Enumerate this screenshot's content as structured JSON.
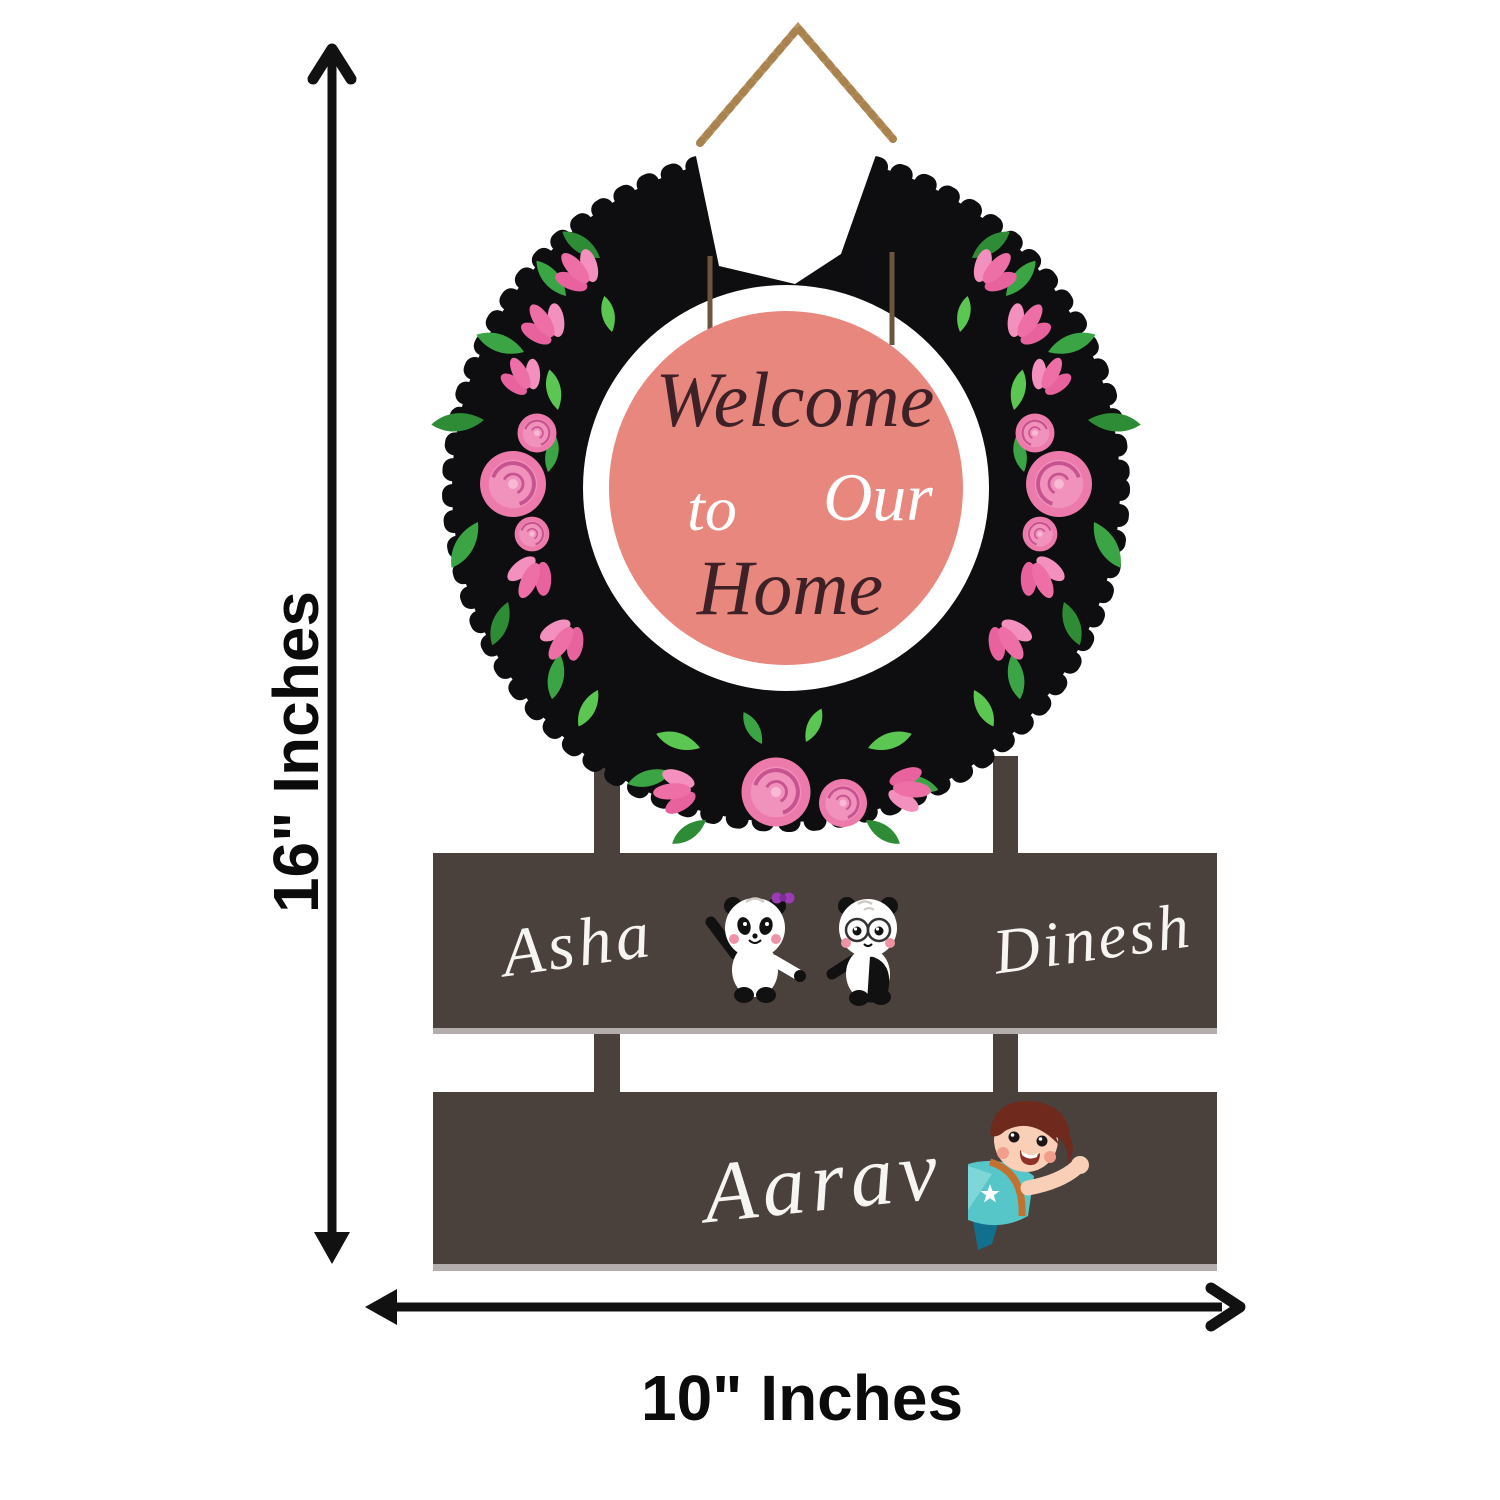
{
  "annotations": {
    "height_label": "16\" Inches",
    "width_label": "10\" Inches"
  },
  "sign": {
    "welcome_circle": {
      "word1": "Welcome",
      "word2": "to",
      "word3": "Our",
      "word4": "Home"
    },
    "plank_top": {
      "left_name": "Asha",
      "right_name": "Dinesh"
    },
    "plank_bottom": {
      "name": "Aarav"
    }
  },
  "icons": {
    "wreath": "floral-wreath",
    "rope": "jute-hanging-rope",
    "panda_left": "panda-with-bow-icon",
    "panda_right": "panda-with-glasses-icon",
    "boy": "waving-boy-icon"
  },
  "colors": {
    "wreath_black": "#0e0d0f",
    "center_circle_pink": "#e8877d",
    "welcome_text_dark": "#3e2127",
    "welcome_text_light": "#ffffff",
    "plank_brown": "#4a403c",
    "plank_shadow": "#b3adad",
    "name_text": "#f7f5f1",
    "flower_pink": "#ec7aab",
    "leaf_green": "#3ba546",
    "rope_tan": "#bc9464",
    "arrow_black": "#111111"
  }
}
